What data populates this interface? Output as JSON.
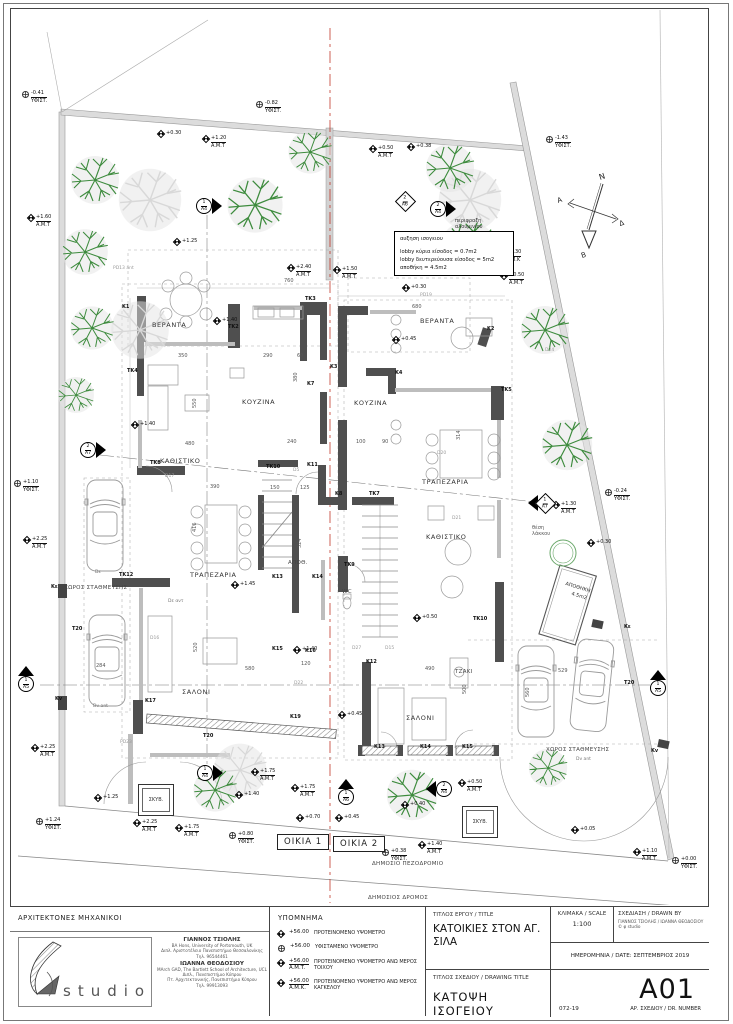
{
  "title_block": {
    "architects_heading": "ΑΡΧΙΤΕΚΤΟΝΕΣ ΜΗΧΑΝΙΚΟΙ",
    "logo_text": "studio",
    "architect1": {
      "name": "ΓΙΑΝΝΟΣ ΤΣΙΟΛΗΣ",
      "lines": [
        "BA Hons, University of Portsmouth, UK",
        "Διπλ. Αριστοτέλειο Πανεπιστήμιο Θεσσαλονίκης",
        "Τηλ. 96544461"
      ]
    },
    "architect2": {
      "name": "ΙΩΑΝΝΑ ΘΕΟΔΟΣΙΟΥ",
      "lines": [
        "MArch GAD, The Bartlett School of Architecture, UCL",
        "Διπλ., Πανεπιστήμιο Κύπρου",
        "Πτ. Αρχιτεκτονικής, Πανεπιστήμιο Κύπρου",
        "Τηλ. 99913093"
      ]
    },
    "project_title_label": "ΤΙΤΛΟΣ ΕΡΓΟΥ / TITLE",
    "project_title": "ΚΑΤΟΙΚΙΕΣ ΣΤΟΝ ΑΓ. ΣΙΛΑ",
    "scale_label": "ΚΛΙΜΑΚΑ / SCALE",
    "scale_value": "1:100",
    "drawn_by_label": "ΣΧΕΔΙΑΣΗ / DRAWN BY",
    "drawn_by_value": "ΓΙΑΝΝΟΣ ΤΣΙΟΛΗΣ / ΙΩΑΝΝΑ ΘΕΟΔΟΣΙΟΥ © φ studio",
    "date_label": "ΗΜΕΡΟΜΗΝΙΑ / DATE: ΣΕΠΤΕΜΒΡΙΟΣ 2019",
    "drawing_title_label": "ΤΙΤΛΟΣ ΣΧΕΔΙΟΥ / DRAWING TITLE",
    "drawing_title": "ΚΑΤΟΨΗ ΙΣΟΓΕΙΟΥ",
    "project_number": "072-19",
    "drawing_number": "A01",
    "drawing_number_label": "ΑΡ. ΣΧΕΔΙΟΥ / DR. NUMBER"
  },
  "legend": {
    "title": "ΥΠΟΜΝΗΜΑ",
    "items": [
      {
        "icon": "spot",
        "value": "+56.00",
        "sub": "",
        "label": "ΠΡΟΤΕΙΝΟΜΕΝΟ ΥΨΟΜΕΤΡΟ"
      },
      {
        "icon": "target",
        "value": "+56.00",
        "sub": "",
        "label": "ΥΦΙΣΤΑΜΕΝΟ ΥΨΟΜΕΤΡΟ"
      },
      {
        "icon": "spot",
        "value": "+56.00",
        "sub": "A.M.T.",
        "label": "ΠΡΟΤΕΙΝΟΜΕΝΟ ΥΨΟΜΕΤΡΟ ΑΝΩ ΜΕΡΟΣ ΤΟΙΧΟΥ"
      },
      {
        "icon": "spot",
        "value": "+56.00",
        "sub": "A.M.K.",
        "label": "ΠΡΟΤΕΙΝΟΜΕΝΟ ΥΨΟΜΕΤΡΟ ΑΝΩ ΜΕΡΟΣ ΚΑΓΚΕΛΟΥ"
      }
    ]
  },
  "north": {
    "n": "N",
    "a": "A",
    "d": "Δ",
    "b": "B"
  },
  "note_box": {
    "title": "αυξηση ισογειου",
    "lines": [
      "lobby κύρια είσοδος = 0.7m2",
      "lobby δευτερεύουσα είσοδος = 5m2",
      "αποθήκη = 4.5m2"
    ]
  },
  "houses": [
    {
      "label": "ΟΙΚΙΑ 1"
    },
    {
      "label": "ΟΙΚΙΑ 2"
    }
  ],
  "skyv_label": "ΣΚΥΒ.",
  "plan": {
    "texts": [
      {
        "t": "ΒΕΡΑΝΤΑ",
        "x": 152,
        "y": 322,
        "c": "rm"
      },
      {
        "t": "ΒΕΡΑΝΤΑ",
        "x": 420,
        "y": 318,
        "c": "rm"
      },
      {
        "t": "ΚΑΘΙΣΤΙΚΟ",
        "x": 160,
        "y": 458,
        "c": "rm"
      },
      {
        "t": "ΚΟΥΖΙΝΑ",
        "x": 242,
        "y": 399,
        "c": "rm"
      },
      {
        "t": "ΚΟΥΖΙΝΑ",
        "x": 354,
        "y": 400,
        "c": "rm"
      },
      {
        "t": "ΤΡΑΠΕΖΑΡΙΑ",
        "x": 190,
        "y": 572,
        "c": "rm"
      },
      {
        "t": "ΤΡΑΠΕΖΑΡΙΑ",
        "x": 422,
        "y": 479,
        "c": "rm"
      },
      {
        "t": "ΚΑΘΙΣΤΙΚΟ",
        "x": 426,
        "y": 534,
        "c": "rm"
      },
      {
        "t": "ΣΑΛΟΝΙ",
        "x": 182,
        "y": 689,
        "c": "rm"
      },
      {
        "t": "ΣΑΛΟΝΙ",
        "x": 406,
        "y": 715,
        "c": "rm"
      },
      {
        "t": "ΑΠΟΘ.",
        "x": 288,
        "y": 560,
        "c": "rm-s"
      },
      {
        "t": "WC",
        "x": 342,
        "y": 589,
        "c": "rm-s"
      },
      {
        "t": "ΤΖΑΚΙ",
        "x": 455,
        "y": 669,
        "c": "rm-s"
      },
      {
        "t": "ΧΩΡΟΣ ΣΤΑΘΜΕΥΣΗΣ",
        "x": 64,
        "y": 585,
        "c": "rm-s"
      },
      {
        "t": "ΧΩΡΟΣ ΣΤΑΘΜΕΥΣΗΣ",
        "x": 546,
        "y": 747,
        "c": "rm-s"
      },
      {
        "t": "ΔΗΜΟΣΙΟ ΠΕΖΟΔΡΟΜΙΟ",
        "x": 372,
        "y": 861,
        "c": "rm-s"
      },
      {
        "t": "ΔΗΜΟΣΙΟΣ ΔΡΟΜΟΣ",
        "x": 368,
        "y": 895,
        "c": "rm-s"
      },
      {
        "t": "ΑΠΟΘΗΚΗ",
        "x": 566,
        "y": 582,
        "c": "st",
        "r": 17
      },
      {
        "t": "4.5m2",
        "x": 572,
        "y": 592,
        "c": "st",
        "r": 17
      },
      {
        "t": "περιφραξη αλουμινίου",
        "x": 455,
        "y": 218,
        "c": "wrap"
      },
      {
        "t": "θέση λάκκου",
        "x": 532,
        "y": 525,
        "c": "wrap2"
      },
      {
        "t": "Dv ant",
        "x": 93,
        "y": 705,
        "c": "tiny"
      },
      {
        "t": "Dv ant",
        "x": 576,
        "y": 758,
        "c": "tiny"
      },
      {
        "t": "Dε",
        "x": 95,
        "y": 571,
        "c": "tiny"
      },
      {
        "t": "Dε αντ",
        "x": 168,
        "y": 600,
        "c": "tiny"
      },
      {
        "t": "760",
        "x": 284,
        "y": 279,
        "c": "dm"
      },
      {
        "t": "350",
        "x": 178,
        "y": 354,
        "c": "dm"
      },
      {
        "t": "290",
        "x": 263,
        "y": 354,
        "c": "dm"
      },
      {
        "t": "60",
        "x": 297,
        "y": 354,
        "c": "dm"
      },
      {
        "t": "680",
        "x": 412,
        "y": 305,
        "c": "dm"
      },
      {
        "t": "550",
        "x": 193,
        "y": 408,
        "c": "dm",
        "r": -90
      },
      {
        "t": "380",
        "x": 294,
        "y": 382,
        "c": "dm",
        "r": -90
      },
      {
        "t": "480",
        "x": 185,
        "y": 442,
        "c": "dm"
      },
      {
        "t": "390",
        "x": 210,
        "y": 485,
        "c": "dm"
      },
      {
        "t": "150",
        "x": 270,
        "y": 486,
        "c": "dm"
      },
      {
        "t": "125",
        "x": 300,
        "y": 486,
        "c": "dm"
      },
      {
        "t": "416",
        "x": 193,
        "y": 532,
        "c": "dm",
        "r": -90
      },
      {
        "t": "324",
        "x": 298,
        "y": 548,
        "c": "dm",
        "r": -90
      },
      {
        "t": "240",
        "x": 287,
        "y": 440,
        "c": "dm"
      },
      {
        "t": "100",
        "x": 356,
        "y": 440,
        "c": "dm"
      },
      {
        "t": "90",
        "x": 382,
        "y": 440,
        "c": "dm"
      },
      {
        "t": "520",
        "x": 194,
        "y": 652,
        "c": "dm",
        "r": -90
      },
      {
        "t": "580",
        "x": 245,
        "y": 667,
        "c": "dm"
      },
      {
        "t": "490",
        "x": 425,
        "y": 667,
        "c": "dm"
      },
      {
        "t": "500",
        "x": 463,
        "y": 694,
        "c": "dm",
        "r": -90
      },
      {
        "t": "314",
        "x": 457,
        "y": 440,
        "c": "dm",
        "r": -90
      },
      {
        "t": "529",
        "x": 558,
        "y": 669,
        "c": "dm"
      },
      {
        "t": "560",
        "x": 526,
        "y": 697,
        "c": "dm",
        "r": -90
      },
      {
        "t": "284",
        "x": 96,
        "y": 664,
        "c": "dm"
      },
      {
        "t": "120",
        "x": 301,
        "y": 662,
        "c": "dm"
      },
      {
        "t": "K1",
        "x": 122,
        "y": 305,
        "c": "cd"
      },
      {
        "t": "TK2",
        "x": 228,
        "y": 325,
        "c": "cd"
      },
      {
        "t": "TK3",
        "x": 305,
        "y": 297,
        "c": "cd"
      },
      {
        "t": "TK4",
        "x": 127,
        "y": 369,
        "c": "cd"
      },
      {
        "t": "K2",
        "x": 487,
        "y": 327,
        "c": "cd"
      },
      {
        "t": "K3",
        "x": 330,
        "y": 365,
        "c": "cd"
      },
      {
        "t": "K4",
        "x": 395,
        "y": 371,
        "c": "cd"
      },
      {
        "t": "K7",
        "x": 307,
        "y": 382,
        "c": "cd"
      },
      {
        "t": "TK5",
        "x": 501,
        "y": 388,
        "c": "cd"
      },
      {
        "t": "K8",
        "x": 335,
        "y": 492,
        "c": "cd"
      },
      {
        "t": "TK7",
        "x": 369,
        "y": 492,
        "c": "cd"
      },
      {
        "t": "TK8",
        "x": 150,
        "y": 461,
        "c": "cd"
      },
      {
        "t": "TK9",
        "x": 344,
        "y": 563,
        "c": "cd"
      },
      {
        "t": "TK10",
        "x": 266,
        "y": 465,
        "c": "cd"
      },
      {
        "t": "TK10",
        "x": 473,
        "y": 617,
        "c": "cd"
      },
      {
        "t": "K11",
        "x": 307,
        "y": 463,
        "c": "cd"
      },
      {
        "t": "TK12",
        "x": 119,
        "y": 573,
        "c": "cd"
      },
      {
        "t": "K13",
        "x": 272,
        "y": 575,
        "c": "cd"
      },
      {
        "t": "K14",
        "x": 312,
        "y": 575,
        "c": "cd"
      },
      {
        "t": "K15",
        "x": 272,
        "y": 647,
        "c": "cd"
      },
      {
        "t": "K16",
        "x": 305,
        "y": 649,
        "c": "cd"
      },
      {
        "t": "K17",
        "x": 145,
        "y": 699,
        "c": "cd"
      },
      {
        "t": "K19",
        "x": 290,
        "y": 715,
        "c": "cd"
      },
      {
        "t": "K12",
        "x": 366,
        "y": 660,
        "c": "cd"
      },
      {
        "t": "K13",
        "x": 374,
        "y": 745,
        "c": "cd"
      },
      {
        "t": "K14",
        "x": 420,
        "y": 745,
        "c": "cd"
      },
      {
        "t": "K15",
        "x": 462,
        "y": 745,
        "c": "cd"
      },
      {
        "t": "T20",
        "x": 72,
        "y": 627,
        "c": "cd"
      },
      {
        "t": "T20",
        "x": 203,
        "y": 734,
        "c": "cd"
      },
      {
        "t": "T20",
        "x": 624,
        "y": 681,
        "c": "cd"
      },
      {
        "t": "Kε",
        "x": 51,
        "y": 585,
        "c": "cd"
      },
      {
        "t": "Kv",
        "x": 55,
        "y": 697,
        "c": "cd"
      },
      {
        "t": "Kε",
        "x": 624,
        "y": 625,
        "c": "cd"
      },
      {
        "t": "Kv",
        "x": 651,
        "y": 749,
        "c": "cd"
      },
      {
        "t": "PD13 ant",
        "x": 113,
        "y": 267,
        "c": "gd"
      },
      {
        "t": "D17",
        "x": 165,
        "y": 475,
        "c": "gd"
      },
      {
        "t": "D5",
        "x": 293,
        "y": 469,
        "c": "gd"
      },
      {
        "t": "PD19",
        "x": 420,
        "y": 294,
        "c": "gd"
      },
      {
        "t": "D24",
        "x": 545,
        "y": 349,
        "c": "gd"
      },
      {
        "t": "D21",
        "x": 452,
        "y": 517,
        "c": "gd"
      },
      {
        "t": "D20",
        "x": 437,
        "y": 452,
        "c": "gd"
      },
      {
        "t": "D16",
        "x": 150,
        "y": 637,
        "c": "gd"
      },
      {
        "t": "D15",
        "x": 385,
        "y": 647,
        "c": "gd"
      },
      {
        "t": "D22",
        "x": 294,
        "y": 682,
        "c": "gd"
      },
      {
        "t": "D27",
        "x": 352,
        "y": 647,
        "c": "gd"
      },
      {
        "t": "PD23",
        "x": 120,
        "y": 741,
        "c": "gd"
      }
    ],
    "elev": [
      {
        "k": "t",
        "x": 22,
        "y": 90,
        "v": "-0.41",
        "s": "ΥΦΙΣΤ."
      },
      {
        "k": "s",
        "x": 158,
        "y": 130,
        "v": "+0.30",
        "s": ""
      },
      {
        "k": "s",
        "x": 203,
        "y": 135,
        "v": "+1.20",
        "s": "A.M.T"
      },
      {
        "k": "s",
        "x": 28,
        "y": 214,
        "v": "+1.60",
        "s": "A.M.T"
      },
      {
        "k": "s",
        "x": 174,
        "y": 238,
        "v": "+1.25",
        "s": ""
      },
      {
        "k": "t",
        "x": 256,
        "y": 100,
        "v": "-0.82",
        "s": "ΥΦΙΣΤ."
      },
      {
        "k": "s",
        "x": 370,
        "y": 145,
        "v": "+0.50",
        "s": "A.M.T"
      },
      {
        "k": "s",
        "x": 408,
        "y": 143,
        "v": "+0.38",
        "s": ""
      },
      {
        "k": "t",
        "x": 546,
        "y": 135,
        "v": "-1.43",
        "s": "ΥΦΙΣΤ."
      },
      {
        "k": "s",
        "x": 498,
        "y": 249,
        "v": "+1.30",
        "s": "A.M.K"
      },
      {
        "k": "s",
        "x": 501,
        "y": 272,
        "v": "+0.50",
        "s": "A.M.T"
      },
      {
        "k": "s",
        "x": 288,
        "y": 264,
        "v": "+2.40",
        "s": "A.M.T"
      },
      {
        "k": "s",
        "x": 334,
        "y": 266,
        "v": "+1.50",
        "s": "A.M.T"
      },
      {
        "k": "s",
        "x": 214,
        "y": 317,
        "v": "+1.40",
        "s": ""
      },
      {
        "k": "s",
        "x": 403,
        "y": 284,
        "v": "+0.30",
        "s": ""
      },
      {
        "k": "s",
        "x": 393,
        "y": 336,
        "v": "+0.45",
        "s": ""
      },
      {
        "k": "s",
        "x": 132,
        "y": 421,
        "v": "+1.40",
        "s": ""
      },
      {
        "k": "t",
        "x": 14,
        "y": 479,
        "v": "+1.10",
        "s": "ΥΦΙΣΤ."
      },
      {
        "k": "s",
        "x": 24,
        "y": 536,
        "v": "+2.25",
        "s": "A.M.T"
      },
      {
        "k": "s",
        "x": 232,
        "y": 581,
        "v": "+1.45",
        "s": ""
      },
      {
        "k": "s",
        "x": 414,
        "y": 614,
        "v": "+0.50",
        "s": ""
      },
      {
        "k": "s",
        "x": 588,
        "y": 539,
        "v": "+0.30",
        "s": ""
      },
      {
        "k": "s",
        "x": 553,
        "y": 501,
        "v": "+1.30",
        "s": "A.M.T"
      },
      {
        "k": "t",
        "x": 605,
        "y": 488,
        "v": "-0.24",
        "s": "ΥΦΙΣΤ."
      },
      {
        "k": "s",
        "x": 339,
        "y": 711,
        "v": "+0.45",
        "s": ""
      },
      {
        "k": "s",
        "x": 294,
        "y": 646,
        "v": "+1.40",
        "s": ""
      },
      {
        "k": "s",
        "x": 32,
        "y": 744,
        "v": "+2.25",
        "s": "A.M.T"
      },
      {
        "k": "s",
        "x": 95,
        "y": 794,
        "v": "+1.25",
        "s": ""
      },
      {
        "k": "t",
        "x": 36,
        "y": 817,
        "v": "+1.24",
        "s": "ΥΦΙΣΤ."
      },
      {
        "k": "s",
        "x": 134,
        "y": 819,
        "v": "+2.25",
        "s": "A.M.T"
      },
      {
        "k": "s",
        "x": 176,
        "y": 824,
        "v": "+1.75",
        "s": "A.M.T"
      },
      {
        "k": "t",
        "x": 229,
        "y": 831,
        "v": "+0.80",
        "s": "ΥΦΙΣΤ."
      },
      {
        "k": "s",
        "x": 252,
        "y": 768,
        "v": "+1.75",
        "s": "A.M.T"
      },
      {
        "k": "s",
        "x": 292,
        "y": 784,
        "v": "+1.75",
        "s": "A.M.T"
      },
      {
        "k": "s",
        "x": 236,
        "y": 791,
        "v": "+1.40",
        "s": ""
      },
      {
        "k": "s",
        "x": 297,
        "y": 814,
        "v": "+0.70",
        "s": ""
      },
      {
        "k": "s",
        "x": 336,
        "y": 814,
        "v": "+0.45",
        "s": ""
      },
      {
        "k": "s",
        "x": 402,
        "y": 801,
        "v": "+0.40",
        "s": ""
      },
      {
        "k": "s",
        "x": 459,
        "y": 779,
        "v": "+0.50",
        "s": "A.M.T"
      },
      {
        "k": "s",
        "x": 419,
        "y": 841,
        "v": "+1.40",
        "s": "A.M.T"
      },
      {
        "k": "t",
        "x": 382,
        "y": 848,
        "v": "+0.38",
        "s": "ΥΦΙΣΤ."
      },
      {
        "k": "s",
        "x": 572,
        "y": 826,
        "v": "+0.05",
        "s": ""
      },
      {
        "k": "s",
        "x": 634,
        "y": 848,
        "v": "+1.10",
        "s": "A.M.T"
      },
      {
        "k": "t",
        "x": 672,
        "y": 856,
        "v": "+0.00",
        "s": "ΥΦΙΣΤ."
      }
    ],
    "sections": [
      {
        "n": "1",
        "sh": "A4",
        "x": 196,
        "y": 198,
        "k": "car"
      },
      {
        "n": "2",
        "sh": "A6",
        "x": 398,
        "y": 194,
        "k": "dia"
      },
      {
        "n": "2",
        "sh": "A4",
        "x": 430,
        "y": 201,
        "k": "car"
      },
      {
        "n": "2",
        "sh": "A7",
        "x": 80,
        "y": 442,
        "k": "car"
      },
      {
        "n": "1",
        "sh": "A7",
        "x": 528,
        "y": 495,
        "k": "dial"
      },
      {
        "n": "1",
        "sh": "A5",
        "x": 18,
        "y": 666,
        "k": "tri"
      },
      {
        "n": "1",
        "sh": "A5",
        "x": 650,
        "y": 670,
        "k": "tri"
      },
      {
        "n": "1",
        "sh": "A4",
        "x": 197,
        "y": 765,
        "k": "car"
      },
      {
        "n": "1",
        "sh": "A6",
        "x": 338,
        "y": 779,
        "k": "tri"
      },
      {
        "n": "2",
        "sh": "A4",
        "x": 426,
        "y": 781,
        "k": "cal"
      }
    ]
  }
}
